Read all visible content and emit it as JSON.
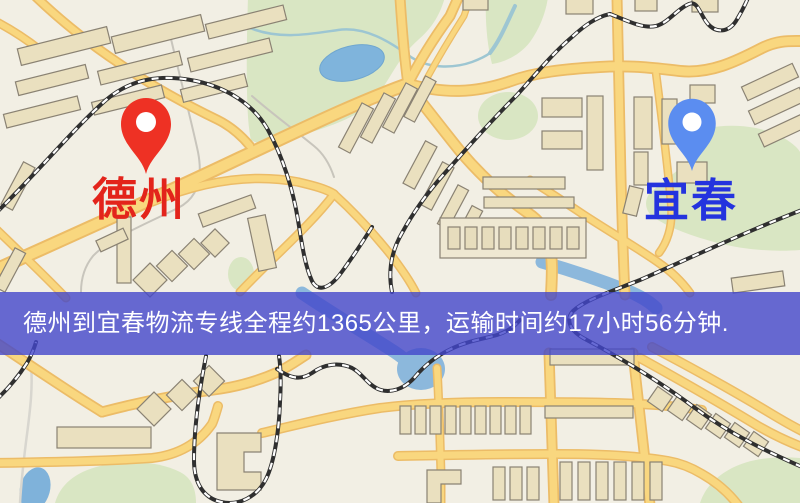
{
  "map": {
    "origin": {
      "label": "德州",
      "pin_icon": "map-pin",
      "pin_color": "#ee3124",
      "label_color": "#e3241b"
    },
    "destination": {
      "label": "宜春",
      "pin_icon": "map-pin",
      "pin_color": "#5b8df0",
      "label_color": "#2433de"
    },
    "banner": {
      "text": "德州到宜春物流专线全程约1365公里，运输时间约17小时56分钟.",
      "background": "rgba(66,70,202,0.80)",
      "text_color": "#ffffff",
      "distance_km": "1365",
      "duration": "17小时56分钟"
    },
    "theme_colors": {
      "map_background": "#f2efe4",
      "road_fill": "#f9d77f",
      "road_casing": "#ecbc67",
      "park_green": "#d9e6c3",
      "water_blue": "#7fb4dc",
      "building_fill": "#eae0bf",
      "railway_dark": "#2f2f2f"
    }
  }
}
